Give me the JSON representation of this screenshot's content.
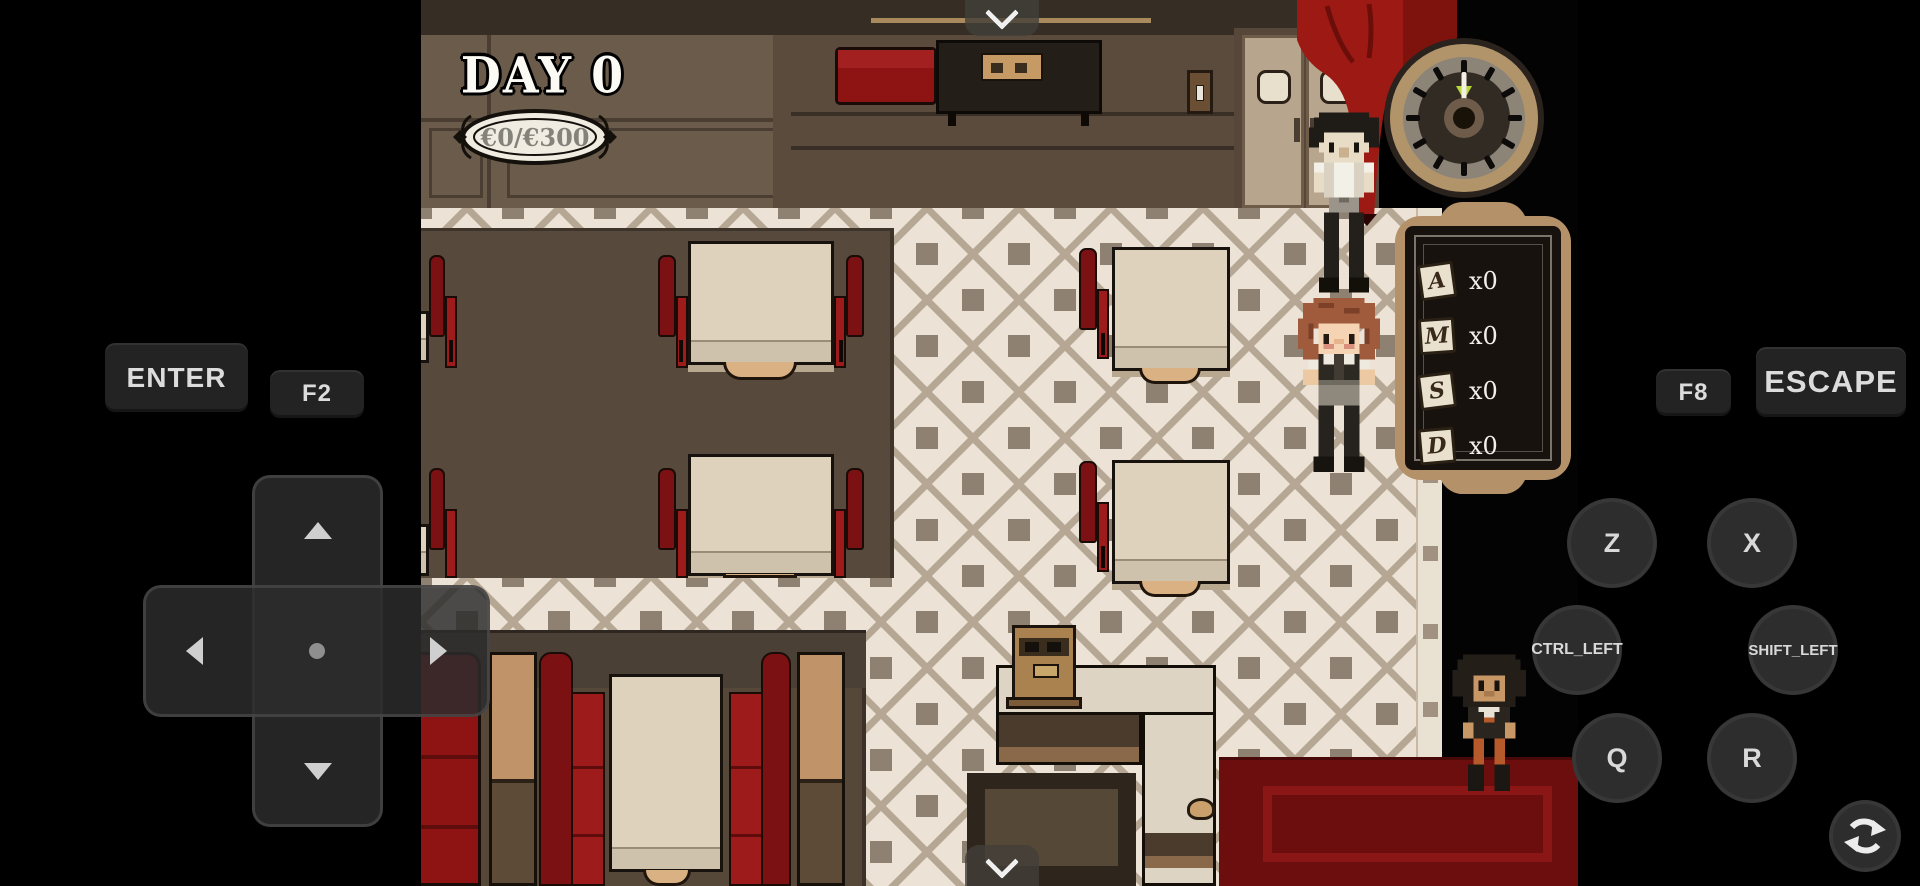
{
  "hud": {
    "day_label": "DAY 0",
    "money": "€0/€300",
    "tickets": [
      {
        "letter": "A",
        "count": "x0"
      },
      {
        "letter": "M",
        "count": "x0"
      },
      {
        "letter": "S",
        "count": "x0"
      },
      {
        "letter": "D",
        "count": "x0"
      }
    ],
    "clock": {
      "hand_position": "12"
    }
  },
  "controls": {
    "enter": "ENTER",
    "f2": "F2",
    "f8": "F8",
    "escape": "ESCAPE",
    "z": "Z",
    "x": "X",
    "ctrl_left": "CTRL_LEFT",
    "shift_left": "SHIFT_LEFT",
    "q": "Q",
    "r": "R"
  },
  "icons": {
    "top_handle": "chevron-down",
    "bottom_handle": "chevron-down",
    "dpad": [
      "up",
      "left",
      "right",
      "down"
    ],
    "bottom_right": "refresh-arrows"
  },
  "colors": {
    "curtain_red": "#9c1a13",
    "booth_red": "#8e1414",
    "carpet_red": "#6d0e0e",
    "wall_brown": "#6a5b4b",
    "floor_cream": "#ece3d6",
    "platform_brown": "#574a3c",
    "clock_ring": "#b2946b",
    "board_frame": "#b5916a",
    "button_dark": "#2d2d2d"
  }
}
